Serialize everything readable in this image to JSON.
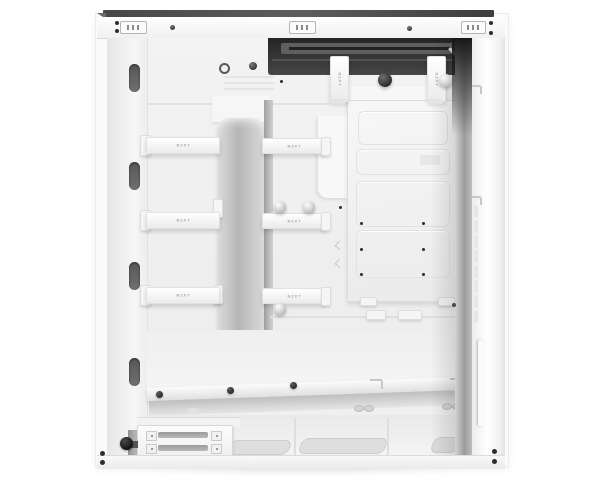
{
  "image": {
    "subject": "White mid-tower PC case shown from the open cable-management side",
    "background": "#ffffff"
  },
  "branding": {
    "strap_label": "NZXT"
  },
  "palette": {
    "case_white": "#f4f4f4",
    "vent_dark": "#2e2e2e",
    "hardware_black": "#2a2a2a",
    "strap_text_gray": "#a3a3a3",
    "shadow_gray": "#bfbfbf"
  },
  "features": {
    "top_rail_slots": 3,
    "rear_cable_ovals": 4,
    "cable_straps_horizontal": 6,
    "cable_straps_vertical": 2,
    "thumbscrews_light": 4,
    "thumbscrews_dark": 2,
    "ssd_plate_screw_holes": 6,
    "psu_bracket_vent_slots": 2,
    "floor_vent_slots": 3,
    "front_vent_dashes": 8
  }
}
